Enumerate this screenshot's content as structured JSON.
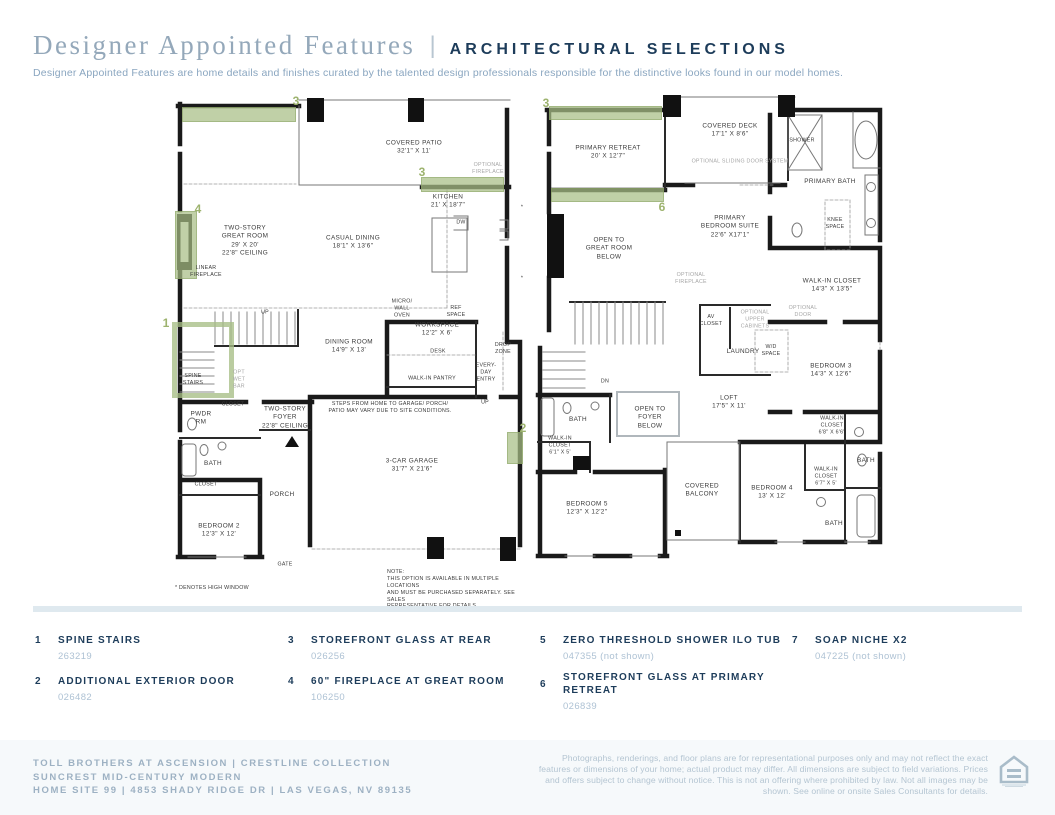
{
  "header": {
    "title": "Designer Appointed Features",
    "separator": "|",
    "tagline": "ARCHITECTURAL SELECTIONS",
    "description": "Designer Appointed Features are home details and finishes curated by the talented design professionals responsible for the distinctive looks found in our model homes."
  },
  "plan1": {
    "name": "first-floor-plan",
    "labels": [
      "COVERED PATIO\n32'1\" X 11'",
      "OPTIONAL\nFIREPLACE",
      "KITCHEN\n21' X 18'7\"",
      "TWO-STORY\nGREAT ROOM\n29' X 20'\n22'8\" CEILING",
      "CASUAL DINING\n18'1\" X 13'6\"",
      "LINEAR\nFIREPLACE",
      "DW",
      "UP",
      "MICRO/\nWALL\nOVEN",
      "REF\nSPACE",
      "WORKSPACE\n12'2\" X 6'",
      "DINING ROOM\n14'9\" X 13'",
      "DESK",
      "DROP\nZONE",
      "SPINE\nSTAIRS",
      "OPT\nWET\nBAR",
      "WALK-IN PANTRY",
      "EVERY-\nDAY\nENTRY",
      "UP",
      "CLOSET",
      "TWO-STORY\nFOYER\n22'8\" CEILING",
      "STEPS FROM HOME TO GARAGE/ PORCH/\nPATIO MAY VARY DUE TO SITE CONDITIONS.",
      "PWDR\nRM",
      "BATH",
      "3-CAR GARAGE\n31'7\" X 21'6\"",
      "CLOSET",
      "PORCH",
      "BEDROOM 2\n12'3\" X 12'",
      "GATE",
      "*",
      "*",
      "* DENOTES HIGH WINDOW",
      "NOTE:\nTHIS OPTION IS AVAILABLE IN MULTIPLE LOCATIONS\nAND MUST BE PURCHASED SEPARATELY. SEE SALES\nREPRESENTATIVE FOR DETAILS."
    ],
    "callouts": [
      "3",
      "3",
      "4",
      "1",
      "2"
    ]
  },
  "plan2": {
    "name": "second-floor-plan",
    "labels": [
      "PRIMARY RETREAT\n20' X 12'7\"",
      "COVERED DECK\n17'1\" X 8'6\"",
      "SHOWER",
      "OPTIONAL SLIDING DOOR SYSTEM",
      "PRIMARY BATH",
      "KNEE\nSPACE",
      "PRIMARY\nBEDROOM SUITE\n22'6\" X17'1\"",
      "OPEN TO\nGREAT ROOM\nBELOW",
      "OPTIONAL\nFIREPLACE",
      "WALK-IN CLOSET\n14'3\" X 13'5\"",
      "OPTIONAL\nDOOR",
      "AV\nCLOSET",
      "OPTIONAL\nUPPER\nCABINETS",
      "LAUNDRY",
      "W/D\nSPACE",
      "DN",
      "BEDROOM 3\n14'3\" X 12'6\"",
      "LOFT\n17'5\" X 11'",
      "BATH",
      "OPEN TO\nFOYER\nBELOW",
      "WALK-IN\nCLOSET\n6'8\" X 6'6\"",
      "WALK-IN\nCLOSET\n6'1\" X 5'",
      "BATH",
      "WALK-IN\nCLOSET\n6'7\" X 5'",
      "COVERED\nBALCONY",
      "BEDROOM 4\n13' X 12'",
      "BEDROOM 5\n12'3\" X 12'2\"",
      "BATH"
    ],
    "callouts": [
      "3",
      "6"
    ]
  },
  "legend": {
    "items": [
      {
        "num": "1",
        "title": "SPINE STAIRS",
        "code": "263219"
      },
      {
        "num": "2",
        "title": "ADDITIONAL EXTERIOR DOOR",
        "code": "026482"
      },
      {
        "num": "3",
        "title": "STOREFRONT GLASS AT REAR",
        "code": "026256"
      },
      {
        "num": "4",
        "title": "60\" FIREPLACE AT GREAT ROOM",
        "code": "106250"
      },
      {
        "num": "5",
        "title": "ZERO THRESHOLD SHOWER ILO TUB",
        "code": "047355 (not shown)"
      },
      {
        "num": "6",
        "title": "STOREFRONT GLASS AT PRIMARY\nRETREAT",
        "code": "026839"
      },
      {
        "num": "7",
        "title": "SOAP NICHE X2",
        "code": "047225 (not shown)"
      }
    ]
  },
  "footer": {
    "community": "TOLL BROTHERS AT ASCENSION  |  CRESTLINE COLLECTION\nSUNCREST MID-CENTURY MODERN\nHOME SITE 99  |  4853 SHADY RIDGE DR  |  LAS VEGAS, NV 89135",
    "disclaimer": "Photographs, renderings, and floor plans are for representational purposes only and may not reflect the exact features or dimensions of your home; actual product may differ. All dimensions are subject to field variations. Prices and offers subject to change without notice. This is not an offering where prohibited by law. Not all images may be shown. See online or onsite Sales Consultants for details.",
    "logo_icon": "equal-housing-logo"
  },
  "colors": {
    "navy": "#1d3c5a",
    "title_blue": "#94a8ba",
    "light_blue": "#8aa6c0",
    "code_blue": "#aec2d4",
    "footer_blue": "#9db1c3",
    "divider": "#dfe9ef",
    "highlight_green": "#a7be85",
    "callout_green": "#9db36e",
    "wall_black": "#1a1a1a"
  }
}
